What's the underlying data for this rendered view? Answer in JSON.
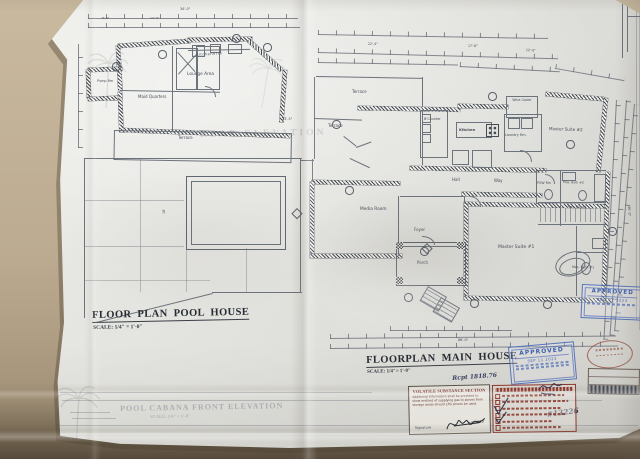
{
  "pool_house": {
    "title": "FLOOR PLAN POOL HOUSE",
    "scale": "SCALE: 1/4\" = 1'-0\"",
    "rooms": {
      "pump": "Pump Rm",
      "maid": "Maid Quarters",
      "lounge": "Lounge Area",
      "kitchenette": "Kitchenette",
      "terrace": "Terrace"
    }
  },
  "main_house": {
    "title": "FLOORPLAN MAIN HOUSE",
    "scale": "SCALE: 1/4\"= 1'-0\"",
    "rooms": {
      "terrace_upper": "Terrace",
      "terrace_lower": "Terrace",
      "b_counter": "B'Counter",
      "kitchen": "Kitchen",
      "laundry": "Laundry Rm.",
      "wine_cooler": "Wine Cooler",
      "master_suite_2": "Master Suite #2",
      "hall": "Hall",
      "way": "Way",
      "media": "Media Room",
      "foyer": "Foyer",
      "porch": "Porch",
      "powder": "POW Rm",
      "mas_bath_2": "Mas. Bath #2",
      "was_closet": "Was. Closet",
      "master_suite_1": "Master Suite #1",
      "mas_bath_1": "Mas. Bath #1"
    }
  },
  "ghost": {
    "cabana_title": "POOL CABANA FRONT ELEVATION",
    "cabana_scale": "SCALE: 1/4\" = 1'-0\"",
    "rear_elevation": "REAR ELEVATION"
  },
  "stamps": {
    "approved_title": {
      "label": "APPROVED",
      "date": "SEP 11 2023"
    },
    "approved_right": {
      "label": "APPROVED",
      "date": "AUG 21 2023"
    },
    "volatile": {
      "title": "VOLATILE SUBSTANCE SECTION",
      "body": "Additional Information shall be provided to show method of supplying gas to stoves from storage areas should LPG stoves be used.",
      "signature_label": "Signature",
      "signed_date": "7/5/2023"
    },
    "permit_ref": "#13226",
    "note": "Rcpt 1818.76"
  },
  "dims": {
    "pool_top": "34'-0\"",
    "pool_seg_a": "8'-0\"",
    "pool_seg_b": "14'-0\"",
    "pool_right": "13'-5\"",
    "pool_depth": "18'",
    "main_a": "22'-4\"",
    "main_b": "17'-8\"",
    "main_c": "12'-0\"",
    "main_bottom": "86'-0\"",
    "main_right": "46'-0\""
  },
  "colors": {
    "approved_blue": "#3f63b5",
    "stamp_red": "#8d3327",
    "paper": "#e6e6e1",
    "plan_line": "#6d737c"
  }
}
